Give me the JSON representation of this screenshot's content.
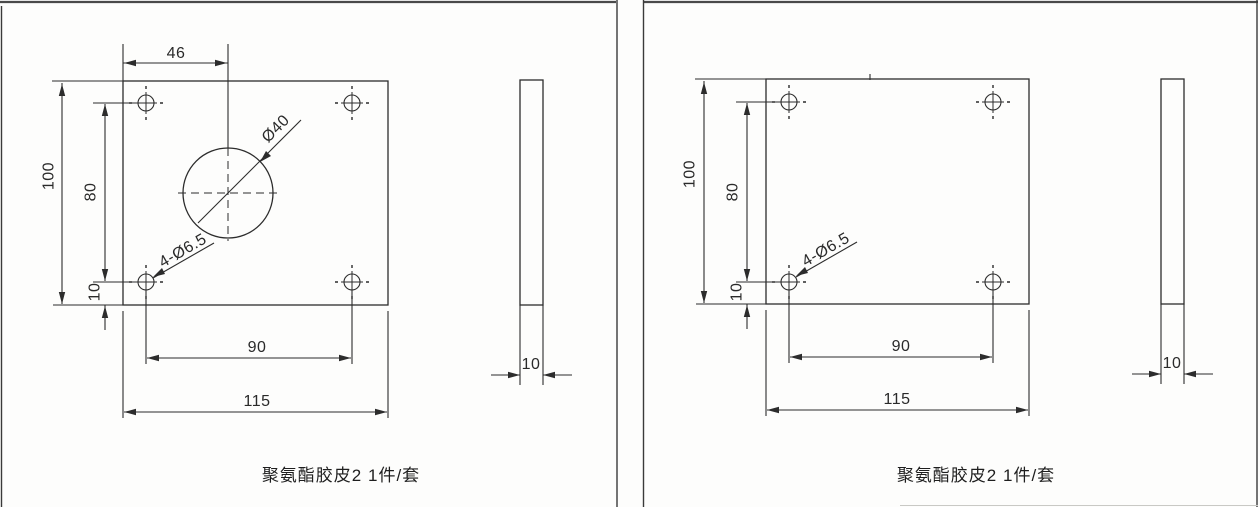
{
  "sheet": {
    "type": "engineering-drawing-scan",
    "colors": {
      "line": "#2c2c2c",
      "background": "#fdfdfc",
      "border": "#4a4a4a"
    }
  },
  "panels": {
    "left": {
      "caption": "聚氨酯胶皮2 1件/套",
      "front": {
        "dim_top_width": "46",
        "dim_height": "100",
        "dim_hole_span_v": "80",
        "dim_bottom_offset": "10",
        "dim_hole_span_h": "90",
        "dim_width": "115",
        "label_center_hole": "Ø40",
        "label_corner_holes": "4-Ø6.5"
      },
      "side": {
        "dim_thickness": "10"
      }
    },
    "right": {
      "caption": "聚氨酯胶皮2 1件/套",
      "front": {
        "dim_height": "100",
        "dim_hole_span_v": "80",
        "dim_bottom_offset": "10",
        "dim_hole_span_h": "90",
        "dim_width": "115",
        "label_corner_holes": "4-Ø6.5"
      },
      "side": {
        "dim_thickness": "10"
      }
    }
  }
}
